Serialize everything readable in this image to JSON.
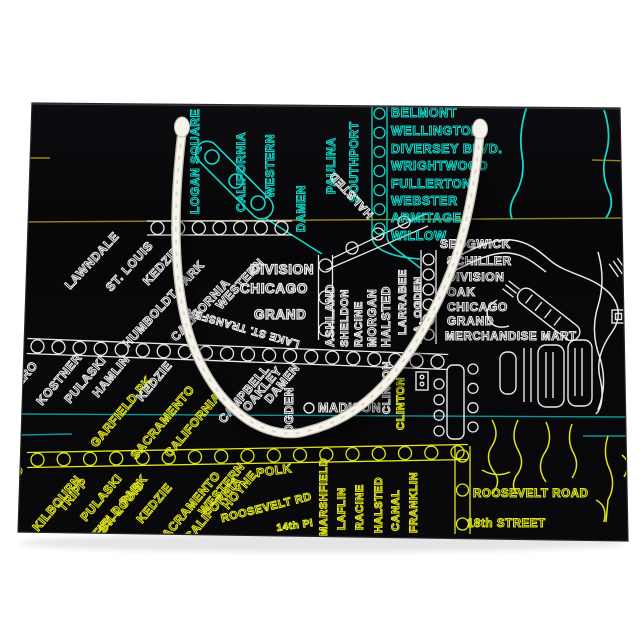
{
  "product": {
    "type_label": "gift-bag-with-chicago-transit-map-print",
    "bag_color": "#07070a",
    "handle_color": "#f5f3ec",
    "background_color": "#ffffff"
  },
  "map": {
    "colors": {
      "cyan": "#15d7c9",
      "white": "#e9e9e9",
      "yellow": "#dfe41e",
      "olive": "#968321",
      "teal": "#0c939b"
    },
    "station_bands": [
      {
        "x1": 147,
        "y1": 228,
        "x2": 292,
        "y2": 228,
        "hw": 7,
        "r": 6.5,
        "n": 7,
        "c": "white"
      },
      {
        "x1": 325.5,
        "y1": 255,
        "x2": 325.5,
        "y2": 340,
        "hw": 7,
        "r": 6.5,
        "n": 3,
        "c": "white"
      },
      {
        "x1": 27,
        "y1": 346,
        "x2": 448,
        "y2": 362,
        "hw": 7.5,
        "r": 6.5,
        "n": 20,
        "c": "white"
      },
      {
        "x1": 27,
        "y1": 460,
        "x2": 468,
        "y2": 452,
        "hw": 7.5,
        "r": 6.5,
        "n": 17,
        "c": "yellow"
      },
      {
        "x1": 379.5,
        "y1": 104,
        "x2": 379.5,
        "y2": 238,
        "hw": 7.5,
        "r": 5.5,
        "n": 7,
        "c": "cyan"
      },
      {
        "x1": 428.5,
        "y1": 250,
        "x2": 428.5,
        "y2": 344,
        "hw": 7.5,
        "r": 5.5,
        "n": 6,
        "c": "white"
      },
      {
        "x1": 462.5,
        "y1": 446,
        "x2": 462.5,
        "y2": 534,
        "hw": 7.5,
        "r": 6,
        "n": 3,
        "c": "yellow"
      },
      {
        "x1": 439,
        "y1": 375,
        "x2": 439,
        "y2": 440,
        "hw": 0,
        "r": 5,
        "n": 4,
        "c": "white"
      },
      {
        "x1": 473,
        "y1": 360,
        "x2": 473,
        "y2": 436,
        "hw": 0,
        "r": 5,
        "n": 4,
        "c": "white"
      }
    ],
    "labels": [
      {
        "t": "LOGAN SQUARE",
        "x": 199,
        "y": 214,
        "r": -90,
        "s": 12,
        "c": "cyan"
      },
      {
        "t": "CALIFORNIA",
        "x": 245,
        "y": 212,
        "r": -90,
        "s": 12,
        "c": "cyan"
      },
      {
        "t": "WESTERN",
        "x": 274,
        "y": 198,
        "r": -90,
        "s": 12,
        "c": "cyan"
      },
      {
        "t": "DAMEN",
        "x": 305,
        "y": 232,
        "r": -90,
        "s": 12,
        "c": "cyan"
      },
      {
        "t": "PAULINA",
        "x": 335,
        "y": 194,
        "r": -90,
        "s": 12,
        "c": "cyan"
      },
      {
        "t": "SOUTHPORT",
        "x": 358,
        "y": 202,
        "r": -90,
        "s": 12,
        "c": "cyan"
      },
      {
        "t": "BELMONT",
        "x": 391,
        "y": 117,
        "r": 0,
        "s": 12.5,
        "c": "cyan"
      },
      {
        "t": "WELLINGTON",
        "x": 391,
        "y": 135,
        "r": 0,
        "s": 12.5,
        "c": "cyan"
      },
      {
        "t": "DIVERSEY BLVD.",
        "x": 391,
        "y": 153,
        "r": 0,
        "s": 12.5,
        "c": "cyan"
      },
      {
        "t": "WRIGHTWOOD",
        "x": 391,
        "y": 170,
        "r": 0,
        "s": 12.5,
        "c": "cyan"
      },
      {
        "t": "FULLERTON",
        "x": 391,
        "y": 188,
        "r": 0,
        "s": 12.5,
        "c": "cyan"
      },
      {
        "t": "WEBSTER",
        "x": 391,
        "y": 205,
        "r": 0,
        "s": 12.5,
        "c": "cyan"
      },
      {
        "t": "ARMITAGE",
        "x": 391,
        "y": 222,
        "r": 0,
        "s": 12.5,
        "c": "cyan"
      },
      {
        "t": "WILLOW",
        "x": 391,
        "y": 240,
        "r": 0,
        "s": 12.5,
        "c": "cyan"
      },
      {
        "t": "SEDGWICK",
        "x": 440,
        "y": 248,
        "r": 0,
        "s": 12,
        "c": "white"
      },
      {
        "t": "SCHILLER",
        "x": 447,
        "y": 265,
        "r": 0,
        "s": 12,
        "c": "white"
      },
      {
        "t": "DIVISION",
        "x": 447,
        "y": 281,
        "r": 0,
        "s": 12,
        "c": "white"
      },
      {
        "t": "OAK",
        "x": 447,
        "y": 296,
        "r": 0,
        "s": 12,
        "c": "white"
      },
      {
        "t": "CHICAGO",
        "x": 447,
        "y": 311,
        "r": 0,
        "s": 12,
        "c": "white"
      },
      {
        "t": "GRAND",
        "x": 447,
        "y": 325,
        "r": 0,
        "s": 12,
        "c": "white"
      },
      {
        "t": "MERCHANDISE MART",
        "x": 445,
        "y": 340,
        "r": 0,
        "s": 11.5,
        "c": "white"
      },
      {
        "t": "DIVISION",
        "x": 250,
        "y": 274,
        "r": 0,
        "s": 13.5,
        "c": "white"
      },
      {
        "t": "CHICAGO",
        "x": 240,
        "y": 293,
        "r": 0,
        "s": 13.5,
        "c": "white"
      },
      {
        "t": "GRAND",
        "x": 254,
        "y": 319,
        "r": 0,
        "s": 13.5,
        "c": "white"
      },
      {
        "t": "MADISON",
        "x": 318,
        "y": 412,
        "r": 0,
        "s": 12.5,
        "c": "white"
      },
      {
        "t": "HALSTED",
        "x": 374,
        "y": 214,
        "r": 227,
        "s": 11.5,
        "c": "white"
      },
      {
        "t": "LAKE ST. TRANSFER",
        "x": 300,
        "y": 341,
        "r": 196,
        "s": 10.5,
        "c": "white"
      },
      {
        "t": "ASHLAND",
        "x": 334,
        "y": 347,
        "r": -90,
        "s": 12,
        "c": "white"
      },
      {
        "t": "SHELDON",
        "x": 348,
        "y": 347,
        "r": -90,
        "s": 11,
        "c": "white"
      },
      {
        "t": "RACINE",
        "x": 362,
        "y": 347,
        "r": -90,
        "s": 11,
        "c": "white"
      },
      {
        "t": "MORGAN",
        "x": 376,
        "y": 347,
        "r": -90,
        "s": 12,
        "c": "white"
      },
      {
        "t": "HALSTED",
        "x": 390,
        "y": 347,
        "r": -90,
        "s": 12,
        "c": "white"
      },
      {
        "t": "LARRABEE",
        "x": 406,
        "y": 335,
        "r": -90,
        "s": 11,
        "c": "white"
      },
      {
        "t": "A. OGDEN",
        "x": 421,
        "y": 333,
        "r": -90,
        "s": 10.5,
        "c": "white"
      },
      {
        "t": "OGDEN",
        "x": 293,
        "y": 434,
        "r": -90,
        "s": 12,
        "c": "white"
      },
      {
        "t": "CLINTON",
        "x": 390,
        "y": 414,
        "r": -90,
        "s": 11,
        "c": "white"
      },
      {
        "t": "CLINTON",
        "x": 404,
        "y": 430,
        "r": -90,
        "s": 11,
        "c": "yellow"
      },
      {
        "t": "LAWNDALE",
        "x": 70,
        "y": 290,
        "r": -47,
        "s": 12,
        "c": "white"
      },
      {
        "t": "ST. LOUIS",
        "x": 111,
        "y": 292,
        "r": -47,
        "s": 12,
        "c": "white"
      },
      {
        "t": "KEDZIE",
        "x": 148,
        "y": 286,
        "r": -47,
        "s": 12,
        "c": "white"
      },
      {
        "t": "HUMBOLDT PARK",
        "x": 128,
        "y": 348,
        "r": -47,
        "s": 12,
        "c": "white"
      },
      {
        "t": "CALIFORNIA",
        "x": 176,
        "y": 342,
        "r": -47,
        "s": 12,
        "c": "white"
      },
      {
        "t": "WESTERN",
        "x": 221,
        "y": 310,
        "r": -47,
        "s": 12,
        "c": "white"
      },
      {
        "t": "CICERO",
        "x": 6,
        "y": 404,
        "r": -50,
        "s": 12,
        "c": "white"
      },
      {
        "t": "KOSTNER",
        "x": 42,
        "y": 406,
        "r": -50,
        "s": 12,
        "c": "white"
      },
      {
        "t": "PULASKI",
        "x": 70,
        "y": 404,
        "r": -50,
        "s": 12,
        "c": "white"
      },
      {
        "t": "HAMLIN",
        "x": 98,
        "y": 398,
        "r": -50,
        "s": 12,
        "c": "white"
      },
      {
        "t": "GARFIELD PK",
        "x": 96,
        "y": 448,
        "r": -50,
        "s": 12,
        "c": "yellow"
      },
      {
        "t": "KEDZIE",
        "x": 142,
        "y": 402,
        "r": -50,
        "s": 12,
        "c": "white"
      },
      {
        "t": "SACRAMENTO",
        "x": 136,
        "y": 460,
        "r": -50,
        "s": 12,
        "c": "yellow"
      },
      {
        "t": "CALIFORNIA",
        "x": 170,
        "y": 458,
        "r": -50,
        "s": 12,
        "c": "yellow"
      },
      {
        "t": "CAMPBELL",
        "x": 224,
        "y": 424,
        "r": -50,
        "s": 12,
        "c": "white"
      },
      {
        "t": "OAKLEY",
        "x": 248,
        "y": 412,
        "r": -50,
        "s": 12,
        "c": "white"
      },
      {
        "t": "DAMEN",
        "x": 270,
        "y": 404,
        "r": -50,
        "s": 12,
        "c": "white"
      },
      {
        "t": "CICERO",
        "x": -8,
        "y": 508,
        "r": -50,
        "s": 12,
        "c": "yellow"
      },
      {
        "t": "KILBOURN",
        "x": 38,
        "y": 532,
        "r": -50,
        "s": 12,
        "c": "yellow"
      },
      {
        "t": "TRIPP",
        "x": 64,
        "y": 512,
        "r": -50,
        "s": 12,
        "c": "yellow"
      },
      {
        "t": "PULASKI",
        "x": 86,
        "y": 522,
        "r": -50,
        "s": 12,
        "c": "yellow"
      },
      {
        "t": "GARFIELD PARK",
        "x": 80,
        "y": 560,
        "r": -50,
        "s": 12,
        "c": "yellow"
      },
      {
        "t": "ST. LOUIS",
        "x": 104,
        "y": 534,
        "r": -50,
        "s": 12,
        "c": "yellow"
      },
      {
        "t": "KEDZIE",
        "x": 142,
        "y": 524,
        "r": -50,
        "s": 12,
        "c": "yellow"
      },
      {
        "t": "SACRAMENTO",
        "x": 162,
        "y": 546,
        "r": -50,
        "s": 12,
        "c": "yellow"
      },
      {
        "t": "CALIFORNIA",
        "x": 190,
        "y": 542,
        "r": -50,
        "s": 12,
        "c": "yellow"
      },
      {
        "t": "WESTERN",
        "x": 204,
        "y": 516,
        "r": -50,
        "s": 12,
        "c": "yellow"
      },
      {
        "t": "HOYNE",
        "x": 228,
        "y": 510,
        "r": -50,
        "s": 12,
        "c": "yellow"
      },
      {
        "t": "POLK",
        "x": 257,
        "y": 477,
        "r": -8,
        "s": 12,
        "c": "yellow"
      },
      {
        "t": "ROOSEVELT RD",
        "x": 222,
        "y": 522,
        "r": -14,
        "s": 11,
        "c": "yellow"
      },
      {
        "t": "14th Pl",
        "x": 277,
        "y": 531,
        "r": -8,
        "s": 10,
        "c": "yellow"
      },
      {
        "t": "MARSHFIELD",
        "x": 327,
        "y": 536,
        "r": -90,
        "s": 11,
        "c": "yellow"
      },
      {
        "t": "LAFLIN",
        "x": 345,
        "y": 530,
        "r": -90,
        "s": 11,
        "c": "yellow"
      },
      {
        "t": "RACINE",
        "x": 363,
        "y": 530,
        "r": -90,
        "s": 11,
        "c": "yellow"
      },
      {
        "t": "HALSTED",
        "x": 382,
        "y": 533,
        "r": -90,
        "s": 11,
        "c": "yellow"
      },
      {
        "t": "CANAL",
        "x": 399,
        "y": 531,
        "r": -90,
        "s": 11,
        "c": "yellow"
      },
      {
        "t": "FRANKLIN",
        "x": 417,
        "y": 533,
        "r": -90,
        "s": 11,
        "c": "yellow"
      },
      {
        "t": "ROOSEVELT ROAD",
        "x": 473,
        "y": 497,
        "r": 0,
        "s": 11.5,
        "c": "yellow"
      },
      {
        "t": "18th STREET",
        "x": 467,
        "y": 527,
        "r": 0,
        "s": 11.5,
        "c": "yellow"
      }
    ]
  }
}
